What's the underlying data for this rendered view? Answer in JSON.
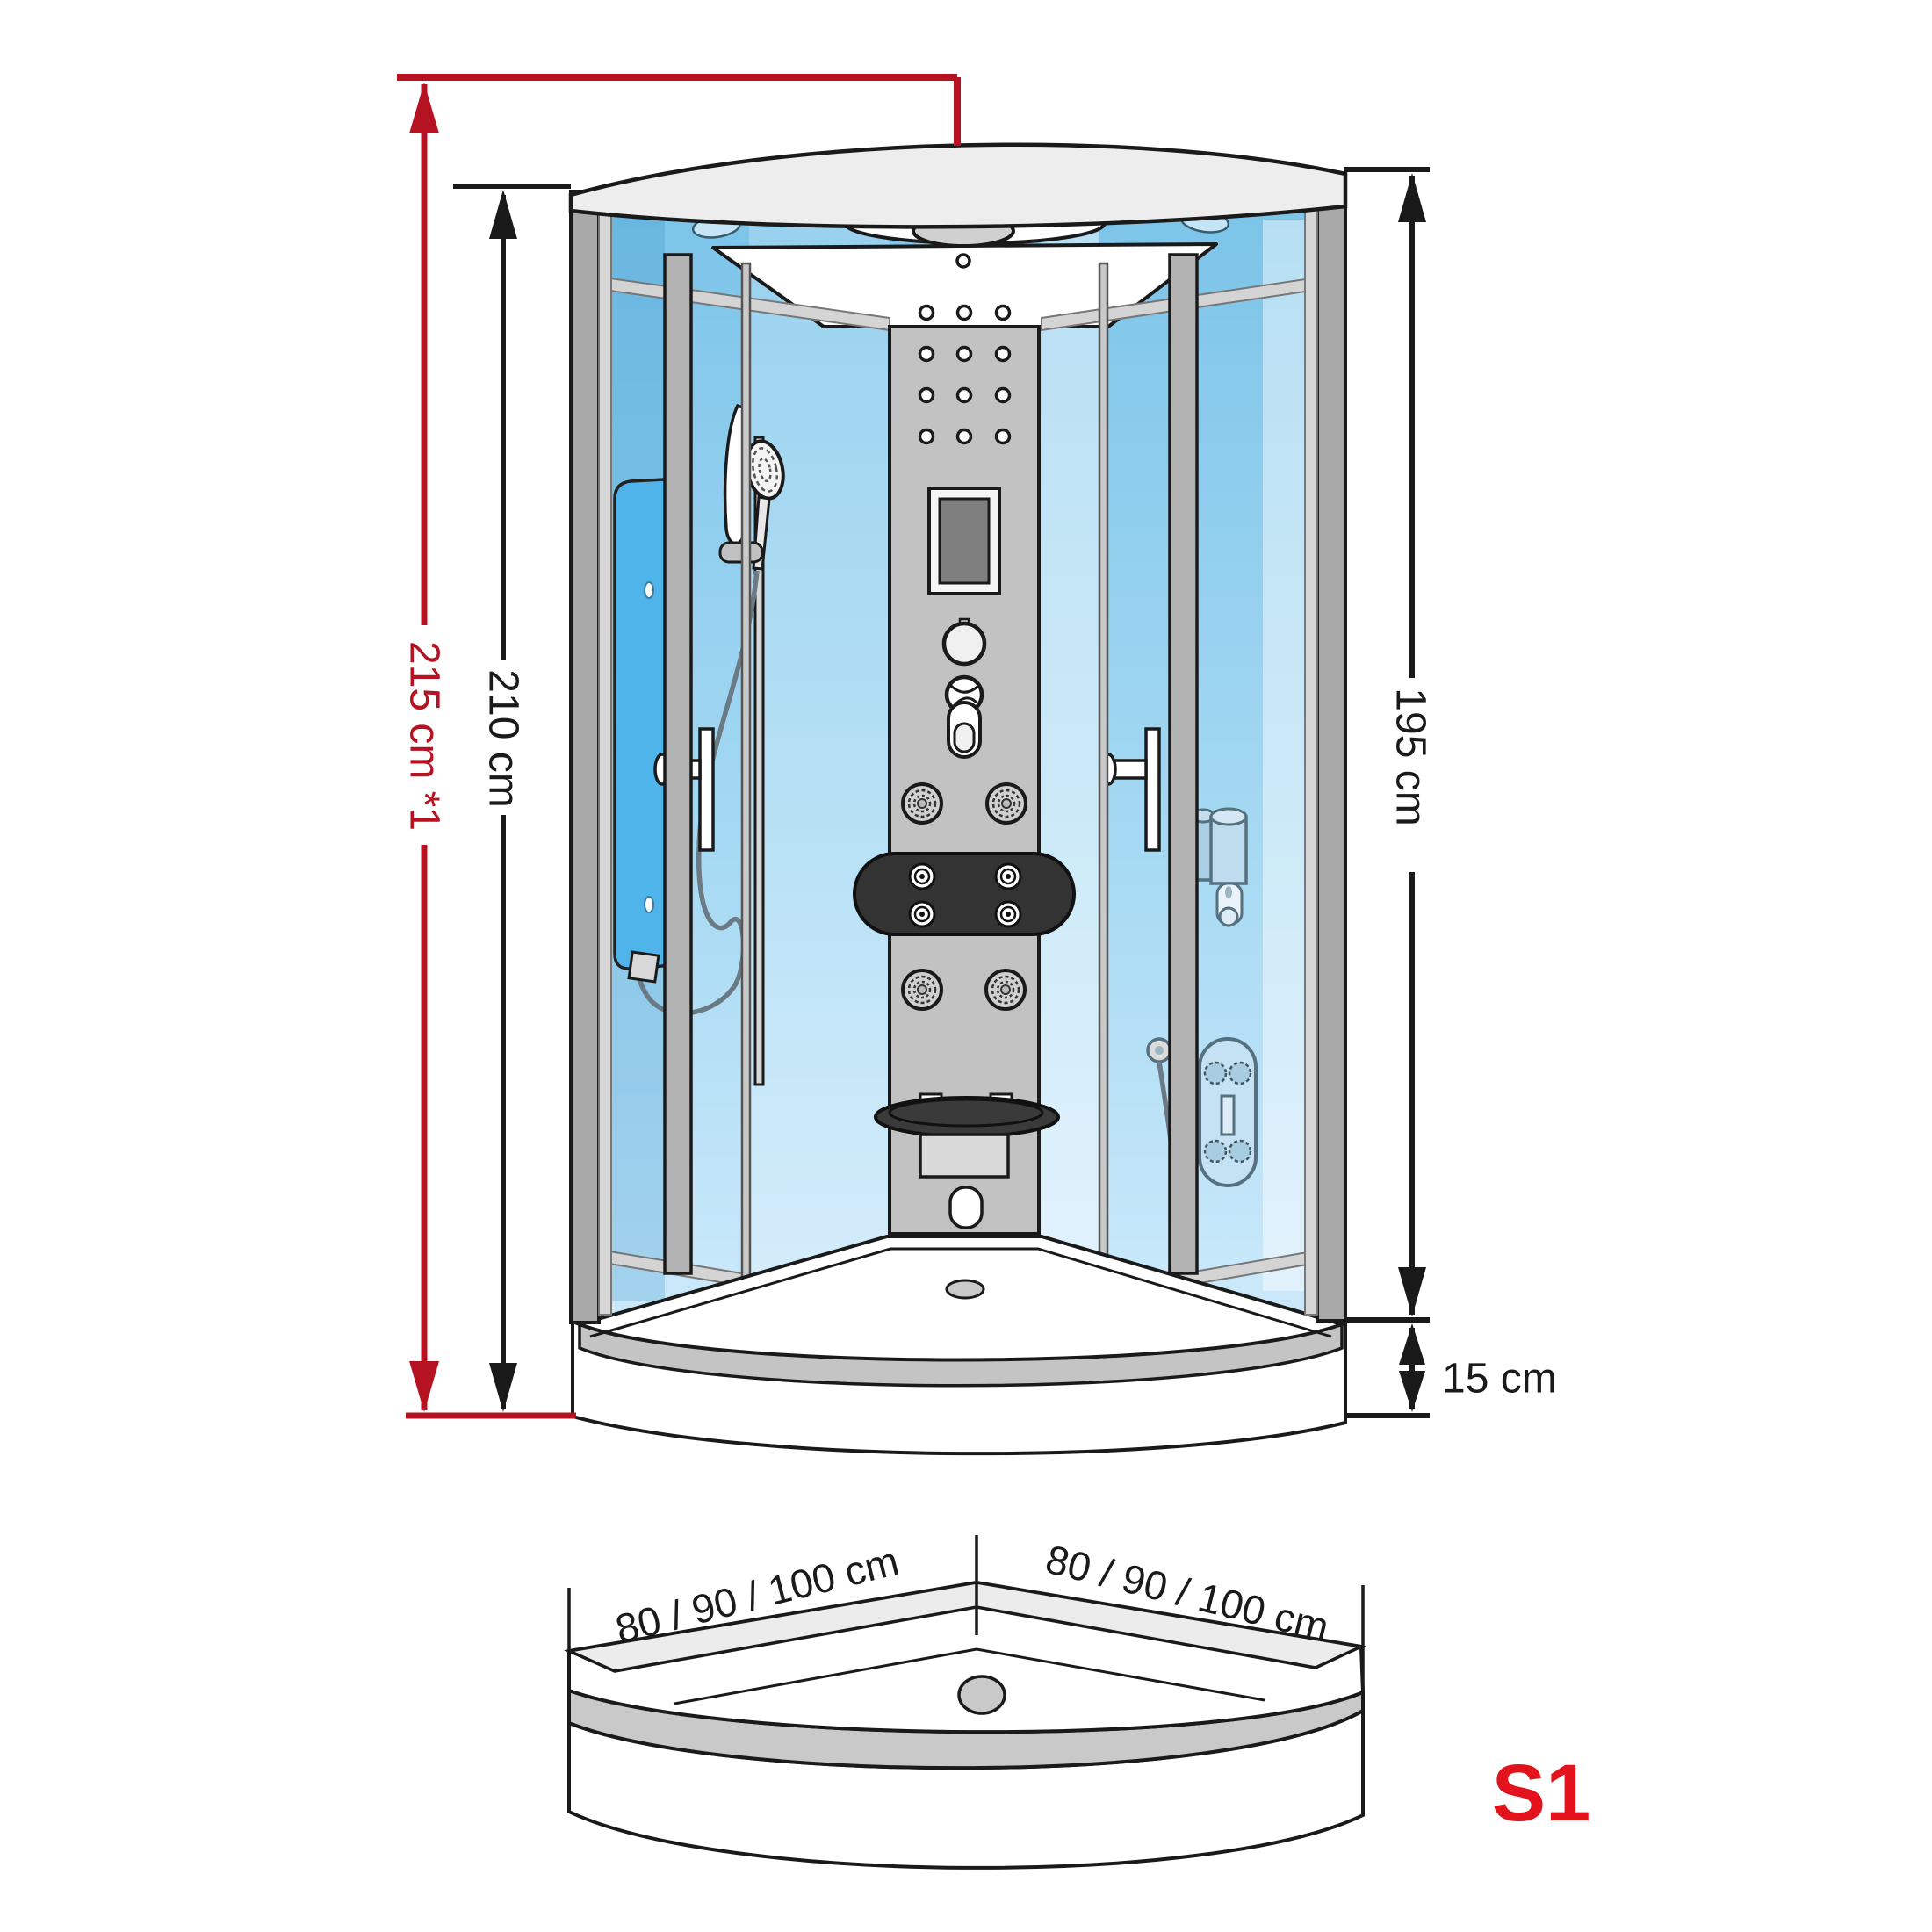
{
  "dimensions": {
    "overall_height": "215 cm *1",
    "cabin_height": "210 cm",
    "glass_height": "195 cm",
    "tray_height": "15 cm"
  },
  "tray": {
    "side_left": "80 / 90 / 100 cm",
    "side_right": "80 / 90 / 100 cm"
  },
  "model": "S1",
  "colors": {
    "dimension_red": "#b51322",
    "model_red": "#e2131c",
    "line_black": "#1a1a1a",
    "glass_blue": "#8fd0ee",
    "frame_gray": "#a9a9a9"
  }
}
